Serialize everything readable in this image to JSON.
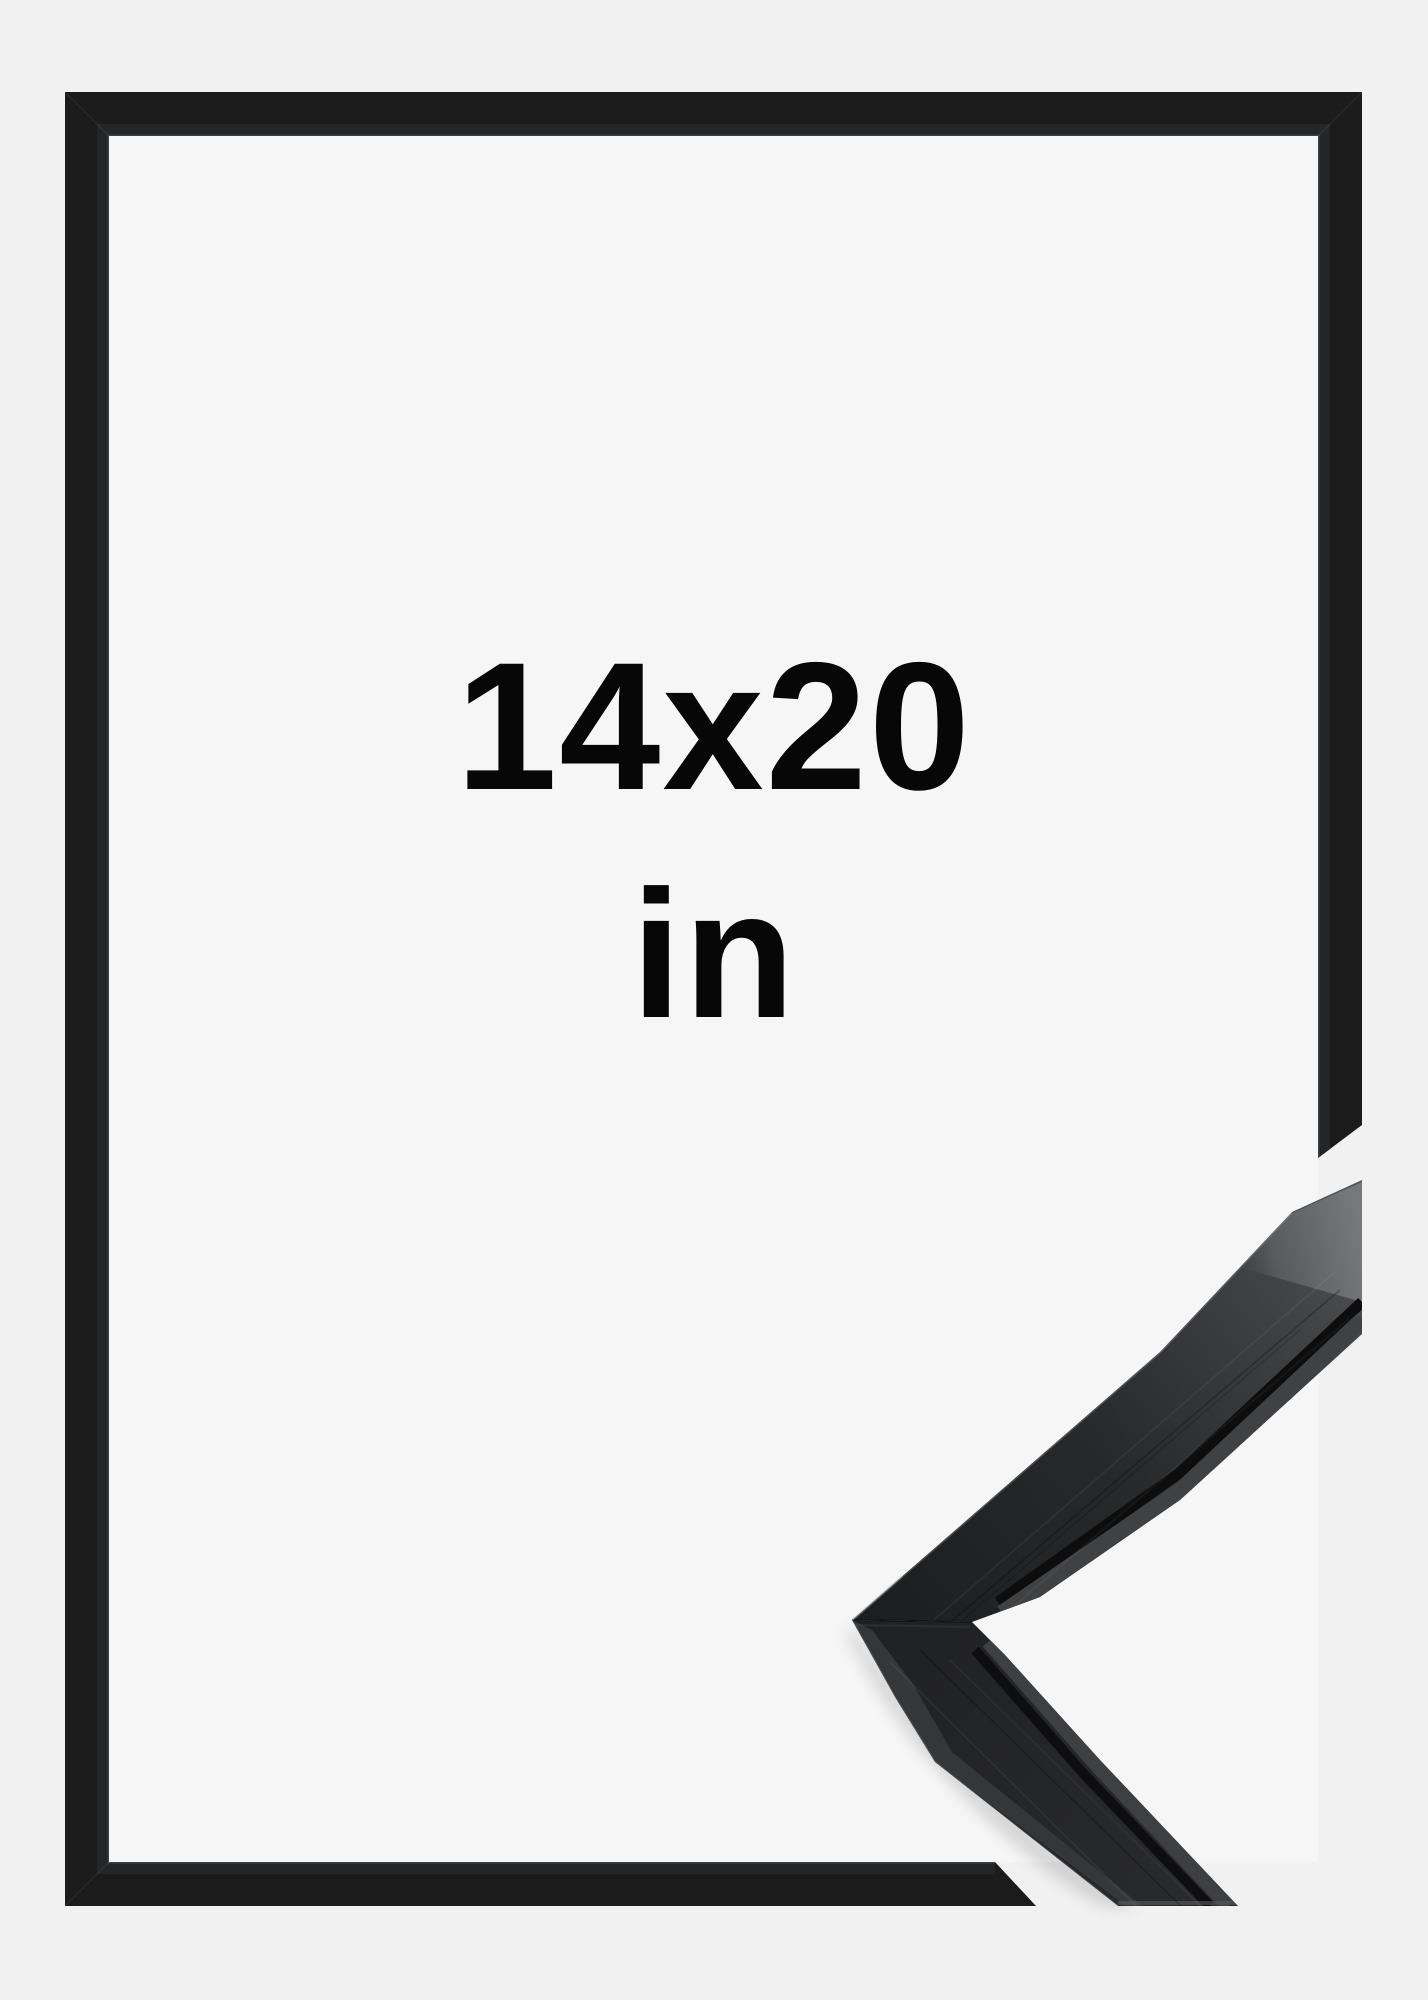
{
  "product_preview": {
    "size_label": "14x20",
    "unit_label": "in",
    "description": "black picture frame size mockup with corner profile sample"
  },
  "colors": {
    "background": "#f1f1f2",
    "frame_interior": "#f6f6f7",
    "frame_black": "#1b1b1c",
    "moulding_end_grain_gray": "#77787a",
    "text": "#070707"
  }
}
